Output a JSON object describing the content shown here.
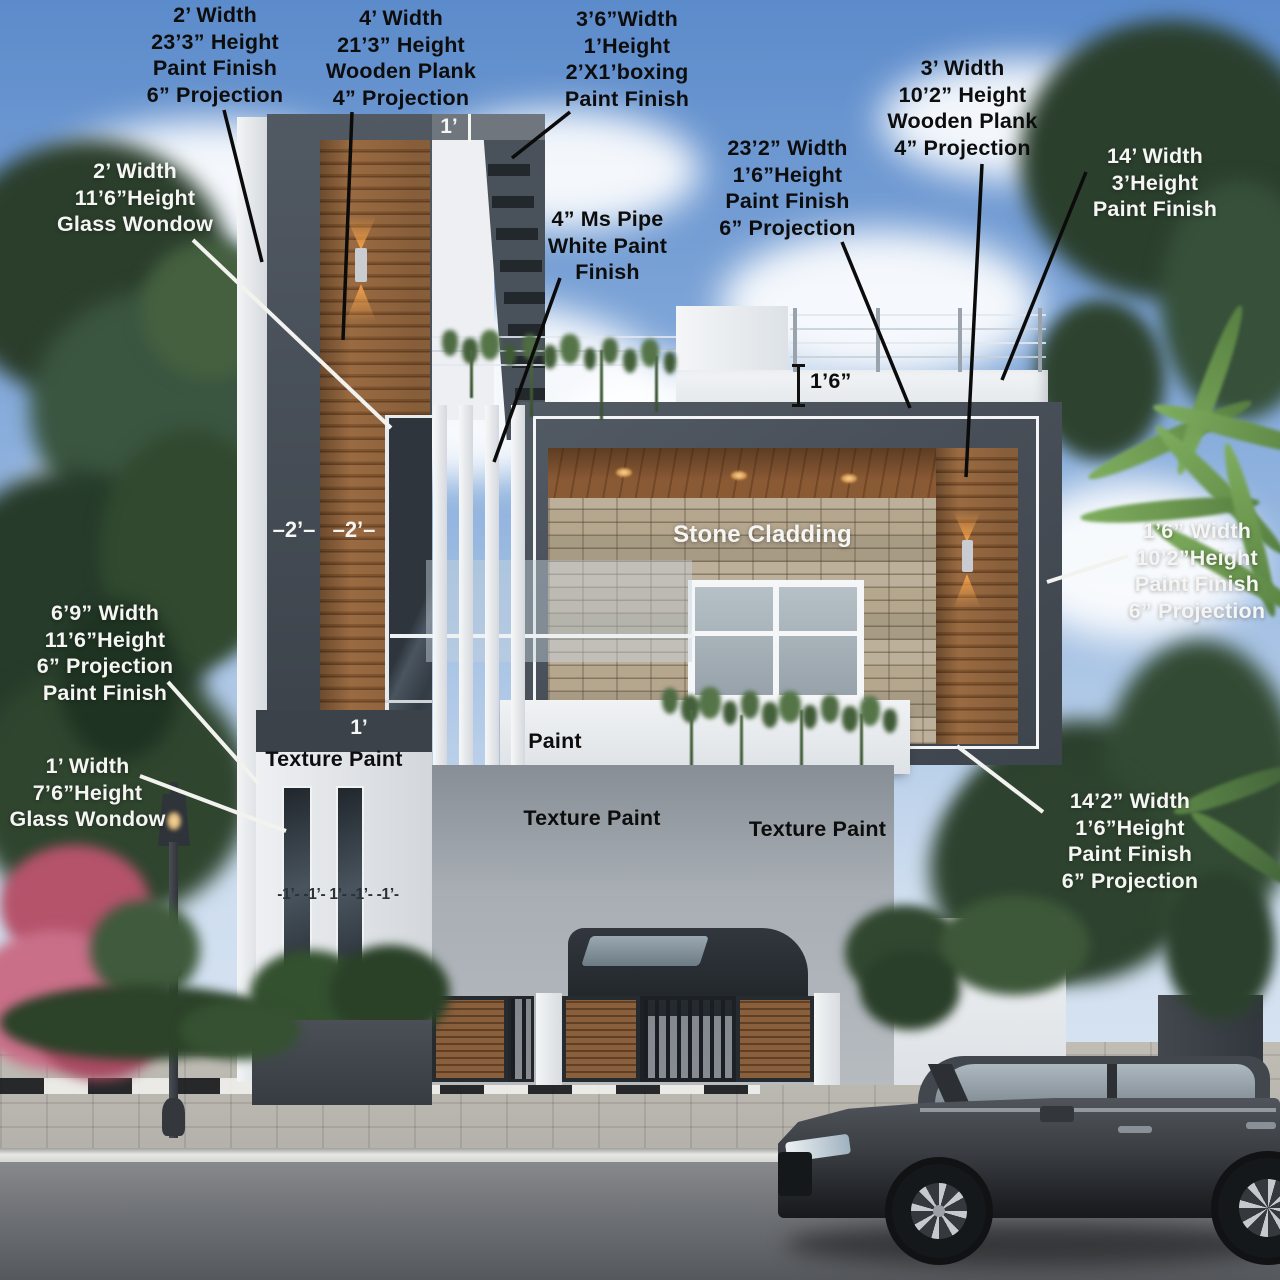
{
  "scene": {
    "title": "Modern G+1 House Front Elevation — annotated render"
  },
  "annotations": {
    "fin_left_tall": "2’ Width\n23’3” Height\nPaint Finish\n6” Projection",
    "wooden_plank_left": "4’ Width\n21’3” Height\nWooden Plank\n4” Projection",
    "boxing_top": "3’6”Width\n1’Height\n2’X1’boxing\nPaint Finish",
    "parapet_front": "23’2” Width\n1’6”Height\nPaint Finish\n6” Projection",
    "wooden_plank_right": "3’ Width\n10’2” Height\nWooden Plank\n4” Projection",
    "parapet_right": "14’ Width\n3’Height\nPaint Finish",
    "glass_window_upper": "2’ Width\n11’6”Height\nGlass Wondow",
    "ms_pipe": "4” Ms Pipe\nWhite Paint\nFinish",
    "dim_roof": "1’6”",
    "stone_cladding": "Stone Cladding",
    "fin_right_column": "1’6” Width\n10’2”Height\nPaint Finish\n6” Projection",
    "dim_2a": "–2’–",
    "dim_2b": "–2’–",
    "projection_left": "6’9” Width\n11’6”Height\n6” Projection\nPaint Finish",
    "glass_window_lower": "1’ Width\n7’6”Height\nGlass Wondow",
    "dim_1_band": "1’",
    "dim_1_top": "1’",
    "texture_paint_left": "Texture Paint",
    "paint_center": "Paint",
    "texture_paint_mid": "Texture Paint",
    "texture_paint_right": "Texture Paint",
    "fin_bottom_right": "14’2” Width\n1’6”Height\nPaint Finish\n6” Projection",
    "dim_pillars": "-1’- -1’- 1’- -1’- -1’-"
  },
  "colors": {
    "frame": "#474e57",
    "frame-dark": "#3b424a",
    "wood": "#96683f",
    "wood-dark": "#6a4527",
    "stone": "#b2a58e",
    "white-wall": "#edeff2",
    "sky-top": "#5c8bcb",
    "sky-bottom": "#cfdeef",
    "glass": "#39414a",
    "foliage": "#33492f",
    "foliage-bright": "#6f9e52",
    "flower-pink": "#c2607a",
    "lamp-glow": "#ffa94d",
    "road": "#6e7175",
    "paver": "#b4b1aa",
    "label-black": "#0d0d0d",
    "label-white": "#f5f5f3"
  }
}
